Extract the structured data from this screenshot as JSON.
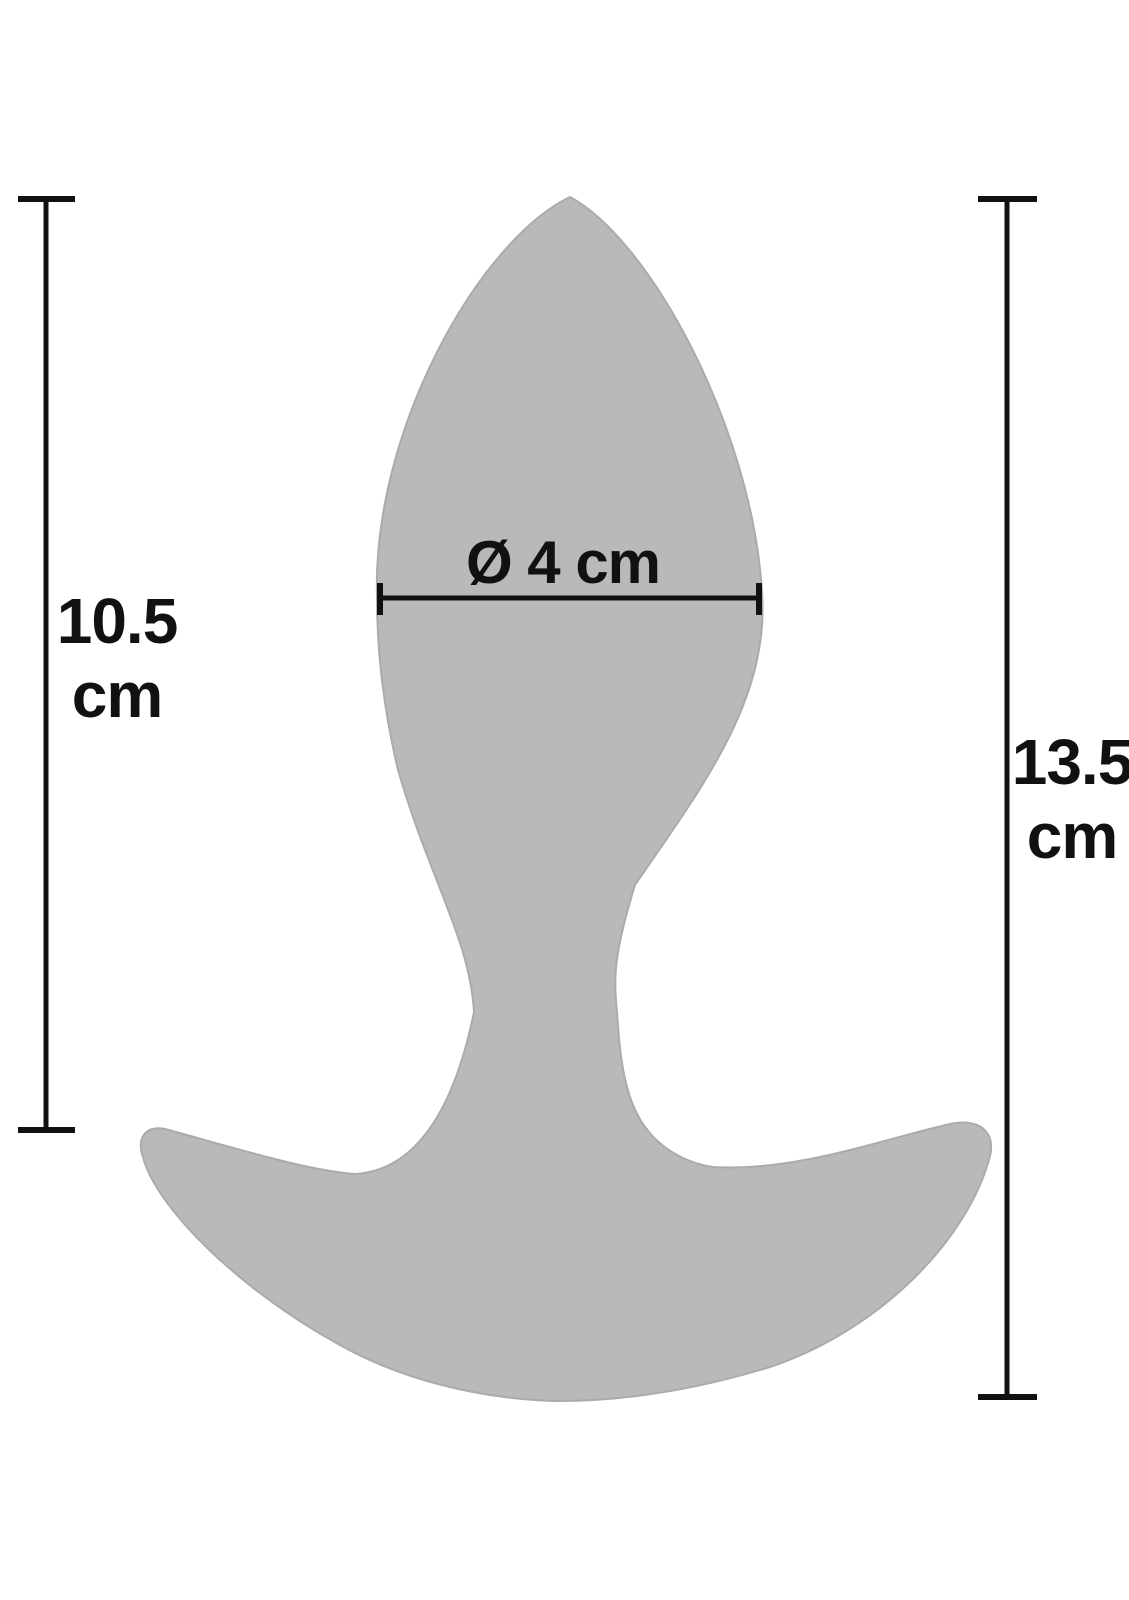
{
  "colors": {
    "background": "#ffffff",
    "product_fill": "#b9b9b9",
    "product_edge": "#ababab",
    "dimension_lines": "#111111",
    "text": "#111111"
  },
  "labels": {
    "left_length": {
      "value": "10.5",
      "unit": "cm"
    },
    "total_length": {
      "value": "13.5",
      "unit": "cm"
    },
    "diameter": {
      "text": "Ø 4 cm"
    }
  }
}
